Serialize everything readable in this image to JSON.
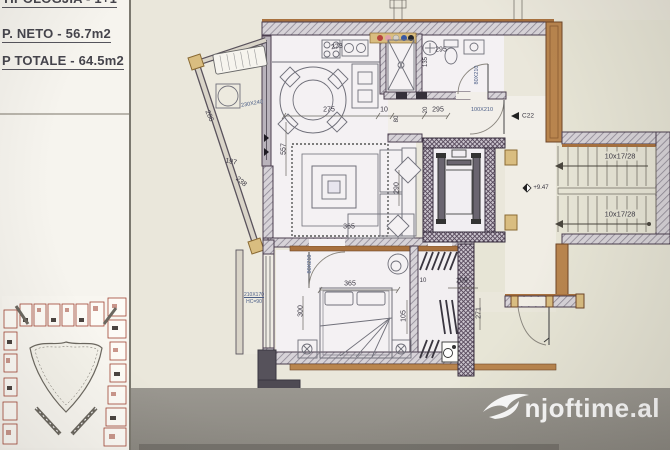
{
  "header": {
    "line1": "TIPOLOGJIA - 1+1",
    "line2": "P. NETO - 56.7m2",
    "line3": "P TOTALE - 64.5m2"
  },
  "watermark": {
    "text": "njoftime.al"
  },
  "plan": {
    "entry_marker": "C22",
    "level_marker": "+9.47",
    "stairs_run_label": "10x17/28",
    "labels": [
      {
        "text": "286",
        "x": 209,
        "y": 116,
        "rot": 66
      },
      {
        "text": "230X240",
        "x": 252,
        "y": 104,
        "rot": -10,
        "size": 5.5,
        "blue": true
      },
      {
        "text": "197",
        "x": 231,
        "y": 162,
        "rot": 11
      },
      {
        "text": "238",
        "x": 241,
        "y": 182,
        "rot": 40
      },
      {
        "text": "557",
        "x": 284,
        "y": 149,
        "rot": -90
      },
      {
        "text": "273",
        "x": 337,
        "y": 47,
        "rot": -8
      },
      {
        "text": "275",
        "x": 329,
        "y": 110,
        "rot": 0
      },
      {
        "text": "10",
        "x": 384,
        "y": 110,
        "rot": 0
      },
      {
        "text": "80",
        "x": 397,
        "y": 119,
        "rot": -90,
        "size": 6
      },
      {
        "text": "20",
        "x": 426,
        "y": 110,
        "rot": -90,
        "size": 6
      },
      {
        "text": "295",
        "x": 441,
        "y": 50,
        "rot": 0
      },
      {
        "text": "135",
        "x": 426,
        "y": 62,
        "rot": -90,
        "size": 6
      },
      {
        "text": "80X210",
        "x": 477,
        "y": 75,
        "rot": -90,
        "size": 5.5,
        "blue": true
      },
      {
        "text": "295",
        "x": 438,
        "y": 110,
        "rot": 0
      },
      {
        "text": "100X210",
        "x": 482,
        "y": 110,
        "rot": 0,
        "size": 5.5,
        "blue": true
      },
      {
        "text": "C22",
        "x": 528,
        "y": 116,
        "rot": 0,
        "size": 6.5
      },
      {
        "text": "290",
        "x": 397,
        "y": 188,
        "rot": -90
      },
      {
        "text": "365",
        "x": 349,
        "y": 227,
        "rot": 0
      },
      {
        "text": "+9.47",
        "x": 541,
        "y": 188,
        "rot": 0,
        "size": 6
      },
      {
        "text": "10x17/28",
        "x": 620,
        "y": 156,
        "rot": 0,
        "size": 7.5,
        "bg": true
      },
      {
        "text": "10x17/28",
        "x": 620,
        "y": 214,
        "rot": 0,
        "size": 7.5,
        "bg": true
      },
      {
        "text": "80X210",
        "x": 310,
        "y": 264,
        "rot": -90,
        "size": 5.5,
        "blue": true
      },
      {
        "text": "300",
        "x": 301,
        "y": 311,
        "rot": -90
      },
      {
        "text": "365",
        "x": 350,
        "y": 284,
        "rot": 0
      },
      {
        "text": "105",
        "x": 404,
        "y": 316,
        "rot": -90
      },
      {
        "text": "210X170",
        "x": 254,
        "y": 295,
        "rot": 0,
        "size": 5,
        "blue": true,
        "underline": true
      },
      {
        "text": "HC=90",
        "x": 254,
        "y": 302,
        "rot": 0,
        "size": 5,
        "blue": true
      },
      {
        "text": "209",
        "x": 462,
        "y": 281,
        "rot": 0
      },
      {
        "text": "271",
        "x": 479,
        "y": 313,
        "rot": -90
      },
      {
        "text": "10",
        "x": 423,
        "y": 281,
        "rot": 0,
        "size": 6
      }
    ]
  },
  "colors": {
    "paper": "#eae7db",
    "exterior": "#e7e5d6",
    "wall_dark": "#4a3d4e",
    "brown": "#a8713e",
    "tan": "#d9bd80",
    "blueprint_label": "#4a5d86",
    "photo_background": "#908d87",
    "watermark": "#ffffff"
  }
}
